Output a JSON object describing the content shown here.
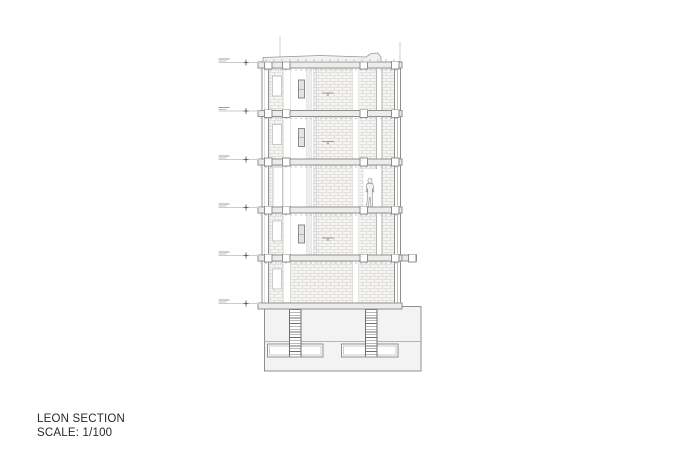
{
  "title_block": {
    "title": "LEON SECTION",
    "scale": "SCALE: 1/100"
  },
  "palette": {
    "paper": "#ffffff",
    "line": "#8f8f8f",
    "line_soft": "#b5b5b5",
    "line_faint": "#cccccc",
    "slab_fill": "#ececec",
    "wall_fill": "#f6f5f3",
    "hatch_line": "#cfcdc8",
    "ground_fill": "#f3f3f3",
    "pile_line": "#707070",
    "figure_line": "#8a8a8a",
    "text": "#2a2a2a"
  },
  "section": {
    "slab_ys": [
      62,
      110.5,
      159,
      207,
      255,
      303
    ],
    "slab_thickness": 6,
    "slab_left": 258,
    "slab_right": 402,
    "wall_left": {
      "x1": 262,
      "x2": 268.5
    },
    "wall_right": {
      "x1": 394.5,
      "x2": 400.5
    },
    "cap_xs": [
      264.5,
      282.5,
      360,
      391.5
    ],
    "cap_size": 7.5,
    "bands": {
      "A": [
        269.5,
        282.5
      ],
      "B": [
        313,
        352.5
      ],
      "C": [
        358.5,
        376
      ],
      "D": [
        382,
        394.5
      ]
    },
    "ground_bands": [
      [
        269.5,
        282.5
      ],
      [
        290,
        352.5
      ],
      [
        358.5,
        394.5
      ]
    ],
    "floors": [
      {
        "slab_y": 62,
        "next": 110.5,
        "lamp": true,
        "window": true,
        "unit": true
      },
      {
        "slab_y": 110.5,
        "next": 159,
        "lamp": true,
        "window": true,
        "unit": true
      },
      {
        "slab_y": 159,
        "next": 207,
        "tall_door": true,
        "door_c": true,
        "figure": true
      },
      {
        "slab_y": 207,
        "next": 255,
        "lamp": true,
        "window": true,
        "unit": true
      },
      {
        "slab_y": 255,
        "next": 303,
        "ground_floor": true,
        "window": true
      }
    ],
    "roof": {
      "path": "M263 62 L263 57.5 L320 55.5 L366 57 L371 53.5 L378 53 L381 57.5 L381 62 Z",
      "tick_from": 266,
      "tick_to": 396,
      "tick_step": 8
    },
    "grid_lines": [
      {
        "x": 280,
        "y1": 36,
        "y2": 57
      },
      {
        "x": 400,
        "y1": 42,
        "y2": 62
      }
    ],
    "balcony": {
      "slab_index": 4,
      "x1": 402,
      "x2": 416.5,
      "cap_x": 408.5
    },
    "levels": [
      {
        "y": 62
      },
      {
        "y": 110.5
      },
      {
        "y": 159
      },
      {
        "y": 207
      },
      {
        "y": 255
      },
      {
        "y": 303
      }
    ],
    "figure": {
      "x": 370,
      "foot_y": 207
    },
    "foundation": {
      "x1": 264.5,
      "x2": 421,
      "y1": 306.5,
      "y2": 371,
      "layer_line_y": 341.5,
      "piles": [
        {
          "x1": 289,
          "x2": 301.5
        },
        {
          "x1": 365,
          "x2": 377.5
        }
      ],
      "pile_top": 308,
      "pile_bottom": 356.5,
      "footings": [
        {
          "x1": 267.5,
          "x2": 323,
          "y1": 344,
          "y2": 357
        },
        {
          "x1": 341.5,
          "x2": 398,
          "y1": 344,
          "y2": 357
        }
      ]
    }
  }
}
